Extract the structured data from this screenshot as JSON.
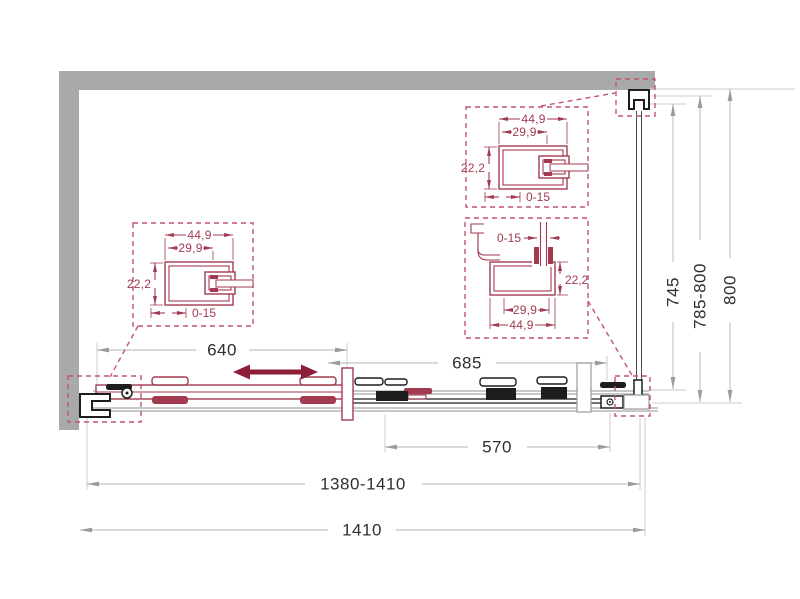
{
  "drawing": {
    "width_dims": {
      "door_travel": "640",
      "fixed_section": "685",
      "fixed_glass": "570",
      "adjustable_width": "1380-1410",
      "overall_width": "1410"
    },
    "height_dims": {
      "glass_height": "745",
      "adjustable_height": "785-800",
      "overall_height": "800"
    },
    "detail_left": {
      "outer": "44,9",
      "inner": "29,9",
      "depth": "22,2",
      "adjust": "0-15"
    },
    "detail_top": {
      "outer": "44,9",
      "inner": "29,9",
      "depth": "22,2",
      "adjust": "0-15"
    },
    "detail_bottom": {
      "adjust": "0-15",
      "depth": "22,2",
      "inner": "29,9",
      "outer": "44,9"
    },
    "colors": {
      "accent": "#a23a50",
      "dashed_box": "#c2556b",
      "slide_arrow": "#8e1e38",
      "wall": "#a7a9ab",
      "dim_line": "#c3c4c6",
      "dim_text": "#2e2f33",
      "profile_dark": "#1d1d1f"
    }
  }
}
